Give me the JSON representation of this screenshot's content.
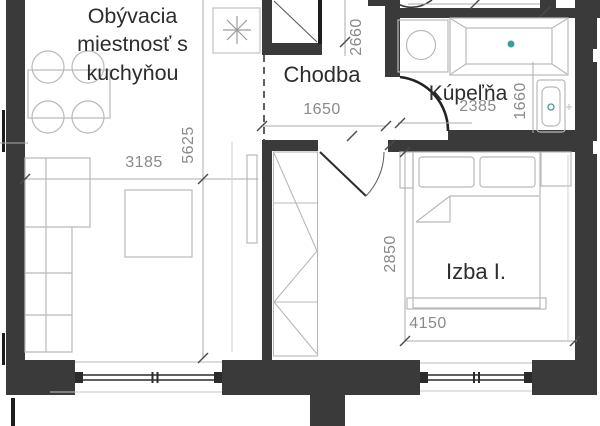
{
  "plan": {
    "title": "apartment-floor-plan",
    "rooms": {
      "living": "Obývacia\nmiestnosť s\nkuchyňou",
      "hallway": "Chodba",
      "bathroom": "Kúpeľňa",
      "room1": "Izba I."
    },
    "dimensions": {
      "hallway_width": "1650",
      "hallway_depth": "2660",
      "bathroom_width": "2385",
      "bathroom_depth": "1660",
      "living_width": "3185",
      "living_depth": "5625",
      "room1_depth": "2850",
      "room1_width": "4150"
    },
    "icons": {
      "kitchen_fixture": "asterisk-fixture",
      "washing_machine": "circle-in-square",
      "bathtub": "rect-with-rim",
      "sink": "rounded-basin",
      "wardrobe": "zigzag-rect",
      "door": "quarter-arc-swing"
    },
    "colors": {
      "wall": "#3a3a3a",
      "furniture_line": "#b9b9b9",
      "dimension_line": "#ababab",
      "dimension_text": "#8a8a8a",
      "label_text": "#2d2d2d",
      "accent": "#3f9e94"
    }
  }
}
